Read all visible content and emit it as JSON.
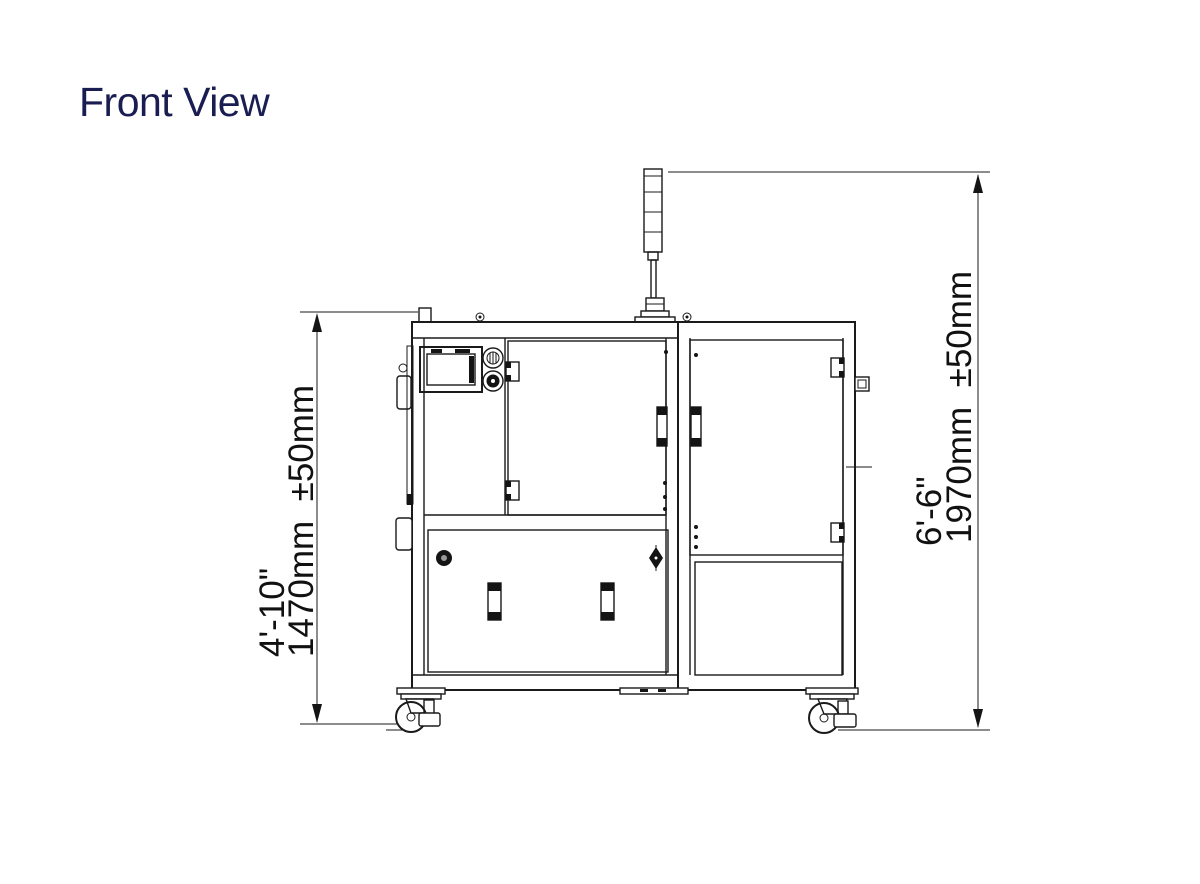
{
  "title": "Front View",
  "colors": {
    "title_text": "#1a1d52",
    "drawing_line": "#1a1a1a",
    "dimension_text": "#111111",
    "background": "#ffffff"
  },
  "dimensions": {
    "left": {
      "imperial": "4'-10\"",
      "metric": "1470mm  ±50mm"
    },
    "right": {
      "imperial": "6'-6\"",
      "metric": "1970mm  ±50mm"
    }
  }
}
